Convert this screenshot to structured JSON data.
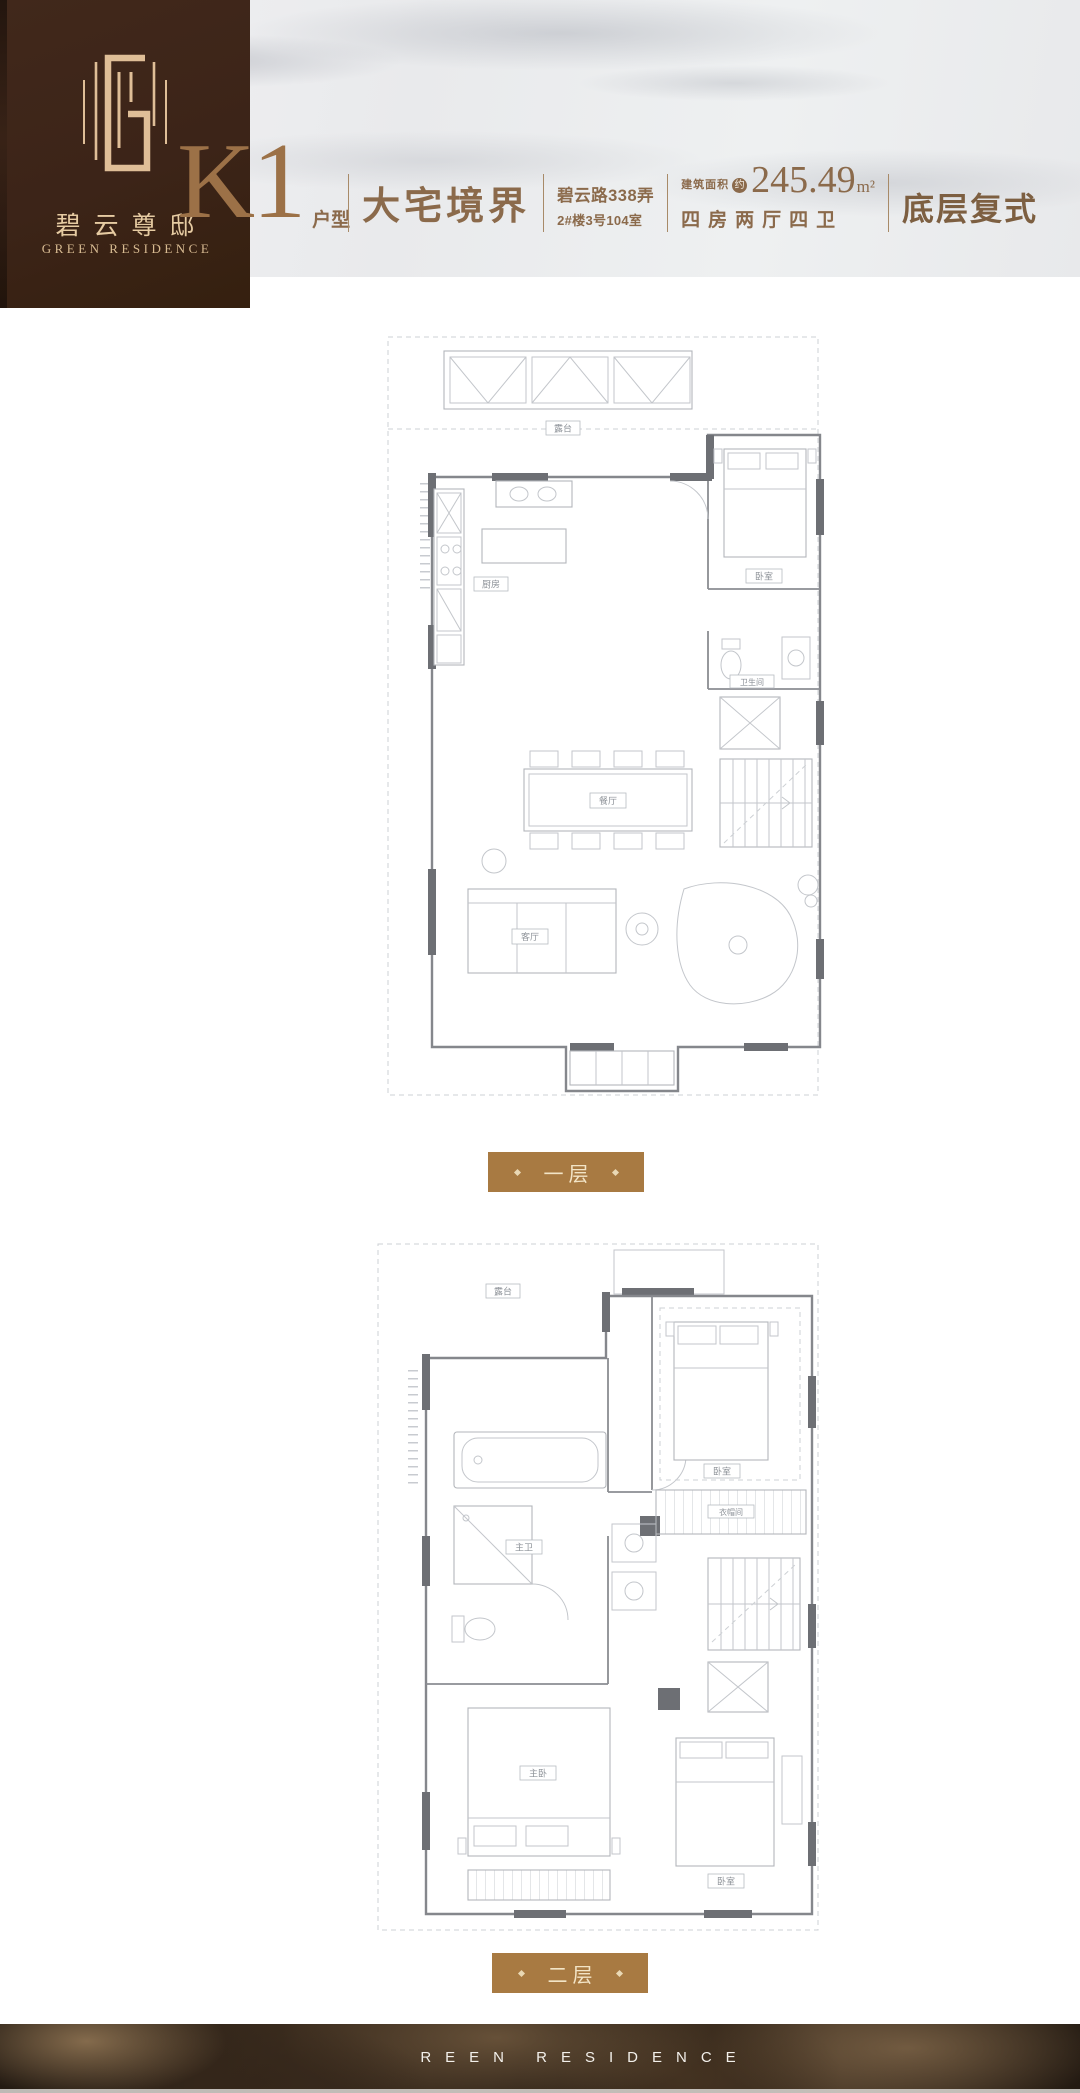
{
  "logo": {
    "monogram": "G",
    "name_cn": "碧云尊邸",
    "name_en": "GREEN RESIDENCE"
  },
  "header": {
    "unit_code": "K1",
    "unit_type": "户型",
    "tagline": "大宅境界",
    "address_line1": "碧云路338弄",
    "address_line2": "2#楼3号104室",
    "area_label": "建筑面积",
    "area_approx": "约",
    "area_value": "245.49",
    "area_unit": "m²",
    "rooms_layout": "四房两厅四卫",
    "duplex": "底层复式"
  },
  "floor1": {
    "badge": "一层",
    "labels": {
      "terrace": "露台",
      "kitchen": "厨房",
      "dining": "餐厅",
      "living": "客厅",
      "bedroom": "卧室",
      "bath": "卫生间"
    }
  },
  "floor2": {
    "badge": "二层",
    "labels": {
      "terrace": "露台",
      "bath": "主卫",
      "closet": "衣帽间",
      "bedroom_top": "卧室",
      "master": "主卧",
      "bedroom_bottom": "卧室"
    }
  },
  "footer": {
    "brand": "REEN RESIDENCE"
  },
  "colors": {
    "brand_brown": "#3c2418",
    "gold": "#dfbe97",
    "header_text": "#8b6a4b",
    "badge_bg": "#a87a42",
    "wall_dark": "#6d6f74"
  }
}
